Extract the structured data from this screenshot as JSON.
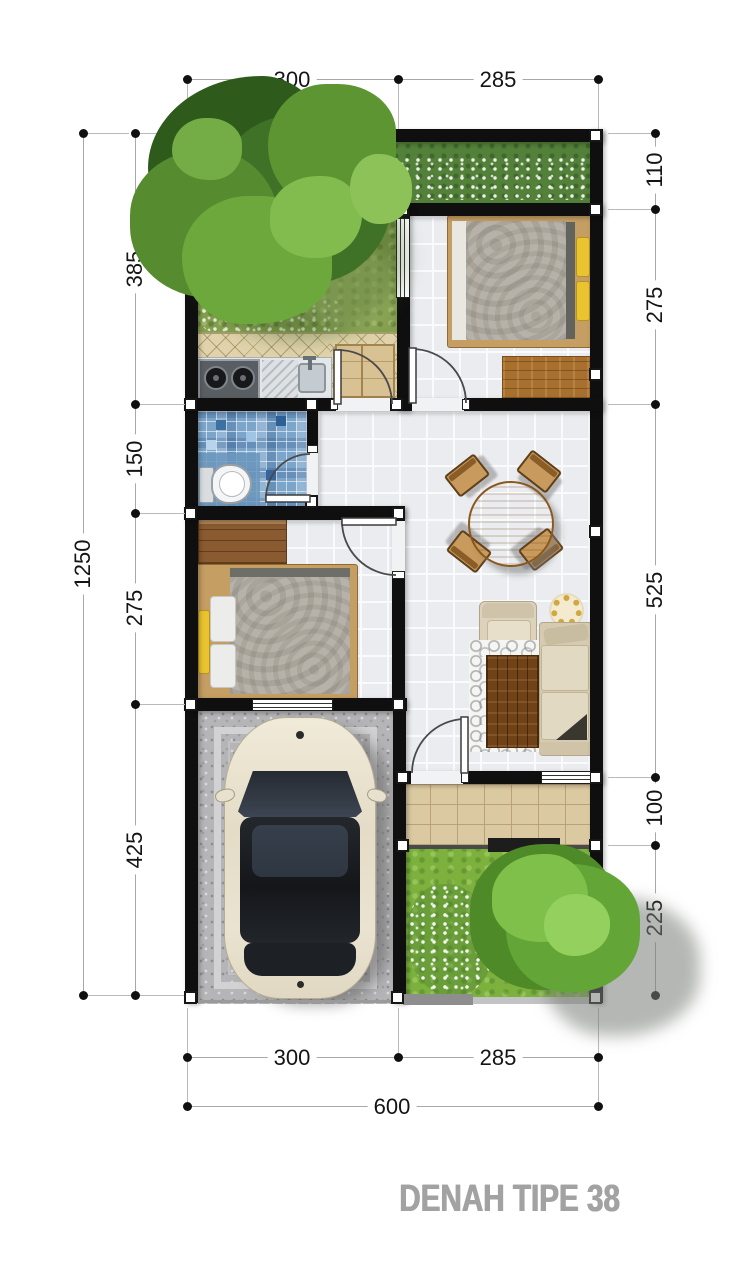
{
  "title": {
    "text": "DENAH TIPE 38"
  },
  "dimensions": {
    "top": [
      "300",
      "285"
    ],
    "bottom": [
      "300",
      "285"
    ],
    "bottom_total": "600",
    "left_outer": "1250",
    "left": [
      "385",
      "150",
      "275",
      "425"
    ],
    "right": [
      "110",
      "275",
      "525",
      "100",
      "225"
    ]
  },
  "colors": {
    "wall": "#0f0f0f",
    "dimension_text": "#141414",
    "title_text": "#a2a2a2",
    "garden_grass": "#85a04f",
    "front_grass": "#7cb13e",
    "bathroom_mosaic": "#7ca5ca",
    "terrace_tile": "#dbc9a1",
    "carport_gravel": "#b5b5b7",
    "bed_blanket": "#b7b2a9",
    "pillow_accent": "#e9c430",
    "sofa": "#d6cbb2",
    "table_wood": "#b57c35"
  }
}
